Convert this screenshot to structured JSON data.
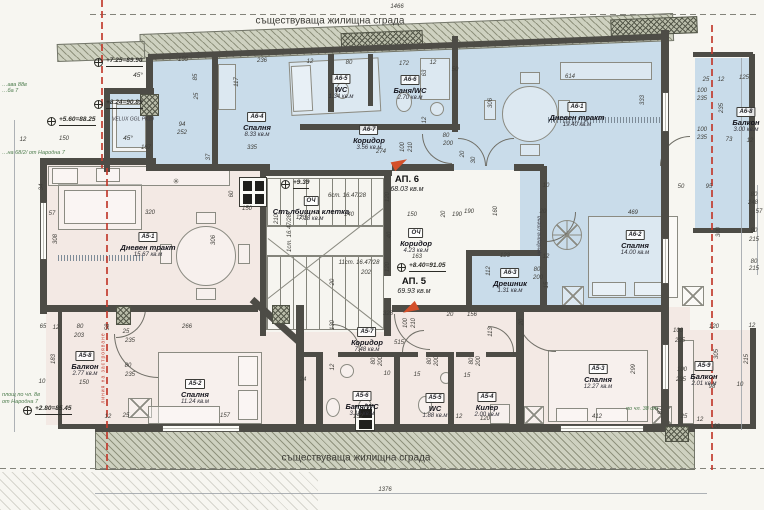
{
  "titles": {
    "top": "съществуваща жилищна сграда",
    "bottom": "съществуваща жилищна сграда"
  },
  "apartments": [
    {
      "id": "АП. 6",
      "area": "68.03 кв.м",
      "x": 407,
      "y": 175
    },
    {
      "id": "АП. 5",
      "area": "69.93 кв.м",
      "x": 414,
      "y": 277
    }
  ],
  "rooms": [
    {
      "code": "А6-1",
      "name": "Дневен тракт",
      "area": "19.40 кв.м",
      "x": 577,
      "y": 96
    },
    {
      "code": "А6-2",
      "name": "Спалня",
      "area": "14.00 кв.м",
      "x": 635,
      "y": 224
    },
    {
      "code": "А6-3",
      "name": "Дрешник",
      "area": "1.31 кв.м",
      "x": 510,
      "y": 262
    },
    {
      "code": "А6-4",
      "name": "Спалня",
      "area": "8.33 кв.м",
      "x": 257,
      "y": 106
    },
    {
      "code": "А6-5",
      "name": "WC",
      "area": "1.34 кв.м",
      "x": 341,
      "y": 68
    },
    {
      "code": "А6-6",
      "name": "Баня/WC",
      "area": "2.70 кв.м",
      "x": 410,
      "y": 69
    },
    {
      "code": "А6-7",
      "name": "Коридор",
      "area": "3.56 кв.м",
      "x": 369,
      "y": 119
    },
    {
      "code": "А6-8",
      "name": "Балкон",
      "area": "3.00 кв.м",
      "x": 746,
      "y": 101
    },
    {
      "code": "ОЧ",
      "name": "Стълбищна клетка",
      "area": "7.18 кв.м",
      "x": 311,
      "y": 190
    },
    {
      "code": "ОЧ",
      "name": "Коридор",
      "area": "4.23 кв.м",
      "x": 416,
      "y": 222
    },
    {
      "code": "А5-1",
      "name": "Дневен тракт",
      "area": "15.67 кв.м",
      "x": 148,
      "y": 226
    },
    {
      "code": "А5-2",
      "name": "Спалня",
      "area": "11.24 кв.м",
      "x": 195,
      "y": 373
    },
    {
      "code": "А5-3",
      "name": "Спалня",
      "area": "12.27 кв.м",
      "x": 598,
      "y": 358
    },
    {
      "code": "А5-4",
      "name": "Килер",
      "area": "2.00 кв.м",
      "x": 487,
      "y": 386
    },
    {
      "code": "А5-5",
      "name": "WC",
      "area": "1.88 кв.м",
      "x": 435,
      "y": 387
    },
    {
      "code": "А5-6",
      "name": "Баня/WC",
      "area": "3.10 кв.м",
      "x": 362,
      "y": 385
    },
    {
      "code": "А5-7",
      "name": "Коридор",
      "area": "7.48 кв.м",
      "x": 367,
      "y": 321
    },
    {
      "code": "А5-8",
      "name": "Балкон",
      "area": "2.77 кв.м",
      "x": 85,
      "y": 345
    },
    {
      "code": "А5-9",
      "name": "Балкон",
      "area": "2.01 кв.м",
      "x": 704,
      "y": 355
    }
  ],
  "stair_runs": [
    [
      "6ст. 16.47/28",
      347,
      196,
      0
    ],
    [
      "1ст. 16.47/28",
      290,
      233,
      1
    ],
    [
      "11ст. 16.47/28",
      359,
      263,
      0
    ]
  ],
  "levels": [
    {
      "t": "+7.25=89.90",
      "x": 106,
      "y": 62
    },
    {
      "t": "+8.24=90.89",
      "x": 106,
      "y": 104
    },
    {
      "t": "+5.60=88.25",
      "x": 59,
      "y": 121
    },
    {
      "t": "+2.80=85.45",
      "x": 35,
      "y": 410
    },
    {
      "t": "+9.39",
      "x": 293,
      "y": 184
    },
    {
      "t": "+8.40=91.05",
      "x": 409,
      "y": 267
    }
  ],
  "notes": [
    [
      "VELUX GGL PK19",
      133,
      120,
      0,
      "tiny"
    ],
    [
      "45°",
      138,
      76,
      0,
      "deg"
    ],
    [
      "45°",
      128,
      139,
      0,
      "deg"
    ],
    [
      "✳",
      176,
      182,
      0,
      "star"
    ],
    [
      "щендерна стена",
      540,
      236,
      1,
      "tiny"
    ],
    [
      "линия на застрояване",
      104,
      368,
      1,
      "redtxt"
    ],
    [
      "…ава 88в",
      2,
      83,
      0,
      "green"
    ],
    [
      "…ба 7",
      2,
      89,
      0,
      "green"
    ],
    [
      "…на 68/2/ от Народна 7",
      2,
      151,
      0,
      "green"
    ],
    [
      "площ по чл. 8в",
      2,
      393,
      0,
      "green"
    ],
    [
      "от Народна 7",
      2,
      400,
      0,
      "green"
    ],
    [
      "по чл. 38 от",
      626,
      407,
      0,
      "green"
    ]
  ],
  "dims": [
    [
      "1466",
      397,
      7,
      0
    ],
    [
      "155",
      183,
      60,
      0
    ],
    [
      "236",
      262,
      61,
      0
    ],
    [
      "12",
      310,
      62,
      0
    ],
    [
      "80",
      349,
      63,
      0
    ],
    [
      "172",
      404,
      64,
      0
    ],
    [
      "12",
      433,
      63,
      0
    ],
    [
      "50",
      455,
      70,
      0
    ],
    [
      "63",
      425,
      73,
      1
    ],
    [
      "614",
      570,
      77,
      0
    ],
    [
      "25",
      706,
      80,
      0
    ],
    [
      "12",
      721,
      80,
      0
    ],
    [
      "125",
      744,
      78,
      0
    ],
    [
      "117",
      237,
      82,
      1
    ],
    [
      "85",
      196,
      77,
      1
    ],
    [
      "25",
      197,
      96,
      1
    ],
    [
      "94",
      182,
      125,
      0
    ],
    [
      "252",
      182,
      133,
      0
    ],
    [
      "167",
      146,
      148,
      0
    ],
    [
      "335",
      252,
      148,
      0
    ],
    [
      "37",
      209,
      157,
      1
    ],
    [
      "12",
      23,
      140,
      0
    ],
    [
      "150",
      64,
      139,
      0
    ],
    [
      "100",
      702,
      91,
      0
    ],
    [
      "235",
      702,
      99,
      0
    ],
    [
      "235",
      722,
      108,
      1
    ],
    [
      "333",
      643,
      100,
      1
    ],
    [
      "306",
      491,
      103,
      1
    ],
    [
      "100",
      702,
      130,
      0
    ],
    [
      "235",
      702,
      138,
      0
    ],
    [
      "73",
      729,
      140,
      0
    ],
    [
      "12",
      750,
      141,
      0
    ],
    [
      "80",
      446,
      136,
      0
    ],
    [
      "200",
      448,
      144,
      0
    ],
    [
      "20",
      463,
      154,
      1
    ],
    [
      "30",
      474,
      160,
      1
    ],
    [
      "274",
      381,
      152,
      0
    ],
    [
      "100",
      403,
      147,
      1
    ],
    [
      "210",
      411,
      147,
      1
    ],
    [
      "12",
      425,
      120,
      1
    ],
    [
      "306",
      214,
      240,
      1
    ],
    [
      "308",
      56,
      239,
      1
    ],
    [
      "57",
      52,
      214,
      0
    ],
    [
      "34",
      42,
      187,
      1
    ],
    [
      "320",
      150,
      213,
      0
    ],
    [
      "60",
      232,
      194,
      1
    ],
    [
      "150",
      247,
      209,
      0
    ],
    [
      "120",
      388,
      197,
      1
    ],
    [
      "140",
      349,
      215,
      0
    ],
    [
      "150",
      412,
      215,
      0
    ],
    [
      "20",
      444,
      214,
      1
    ],
    [
      "190",
      457,
      215,
      0
    ],
    [
      "40",
      390,
      235,
      1
    ],
    [
      "163",
      417,
      257,
      0
    ],
    [
      "120",
      388,
      267,
      1
    ],
    [
      "202",
      366,
      273,
      0
    ],
    [
      "20",
      333,
      282,
      1
    ],
    [
      "210",
      277,
      219,
      1
    ],
    [
      "120",
      301,
      218,
      0
    ],
    [
      "10",
      546,
      186,
      0
    ],
    [
      "50",
      681,
      187,
      0
    ],
    [
      "95",
      709,
      187,
      0
    ],
    [
      "80",
      754,
      195,
      0
    ],
    [
      "248",
      753,
      203,
      0
    ],
    [
      "57",
      759,
      212,
      0
    ],
    [
      "20",
      543,
      212,
      0
    ],
    [
      "469",
      633,
      213,
      0
    ],
    [
      "300",
      719,
      232,
      1
    ],
    [
      "80",
      754,
      231,
      0
    ],
    [
      "215",
      754,
      240,
      0
    ],
    [
      "80",
      754,
      262,
      0
    ],
    [
      "215",
      754,
      269,
      0
    ],
    [
      "123",
      505,
      256,
      0
    ],
    [
      "12",
      546,
      257,
      0
    ],
    [
      "80",
      537,
      270,
      0
    ],
    [
      "200",
      538,
      278,
      0
    ],
    [
      "15",
      547,
      285,
      1
    ],
    [
      "112",
      489,
      271,
      1
    ],
    [
      "190",
      469,
      212,
      0
    ],
    [
      "160",
      496,
      211,
      1
    ],
    [
      "65",
      43,
      327,
      0
    ],
    [
      "12",
      56,
      328,
      0
    ],
    [
      "80",
      80,
      327,
      0
    ],
    [
      "203",
      79,
      336,
      0
    ],
    [
      "58",
      108,
      327,
      1
    ],
    [
      "25",
      126,
      332,
      0
    ],
    [
      "235",
      130,
      341,
      0
    ],
    [
      "266",
      187,
      327,
      0
    ],
    [
      "80",
      128,
      366,
      0
    ],
    [
      "235",
      130,
      375,
      0
    ],
    [
      "10",
      42,
      382,
      0
    ],
    [
      "150",
      84,
      383,
      0
    ],
    [
      "183",
      54,
      359,
      1
    ],
    [
      "12",
      108,
      417,
      0
    ],
    [
      "25",
      126,
      416,
      0
    ],
    [
      "157",
      225,
      416,
      0
    ],
    [
      "328",
      388,
      314,
      0
    ],
    [
      "20",
      450,
      315,
      0
    ],
    [
      "156",
      472,
      315,
      0
    ],
    [
      "130",
      333,
      325,
      1
    ],
    [
      "100",
      406,
      323,
      1
    ],
    [
      "210",
      414,
      323,
      1
    ],
    [
      "515",
      399,
      343,
      0
    ],
    [
      "113",
      491,
      332,
      1
    ],
    [
      "80",
      374,
      361,
      1
    ],
    [
      "200",
      381,
      361,
      1
    ],
    [
      "80",
      430,
      361,
      1
    ],
    [
      "200",
      437,
      361,
      1
    ],
    [
      "80",
      472,
      361,
      1
    ],
    [
      "200",
      479,
      361,
      1
    ],
    [
      "10",
      387,
      374,
      0
    ],
    [
      "15",
      417,
      375,
      0
    ],
    [
      "15",
      467,
      376,
      0
    ],
    [
      "24",
      303,
      380,
      0
    ],
    [
      "12",
      333,
      367,
      1
    ],
    [
      "152",
      358,
      417,
      0
    ],
    [
      "12",
      459,
      417,
      0
    ],
    [
      "120",
      485,
      419,
      0
    ],
    [
      "20",
      522,
      322,
      1
    ],
    [
      "100",
      678,
      331,
      0
    ],
    [
      "235",
      680,
      341,
      0
    ],
    [
      "120",
      714,
      327,
      0
    ],
    [
      "12",
      752,
      326,
      0
    ],
    [
      "305",
      717,
      354,
      1
    ],
    [
      "215",
      747,
      359,
      1
    ],
    [
      "100",
      682,
      370,
      0
    ],
    [
      "235",
      681,
      380,
      0
    ],
    [
      "299",
      634,
      369,
      1
    ],
    [
      "98",
      712,
      387,
      0
    ],
    [
      "10",
      740,
      385,
      0
    ],
    [
      "412",
      597,
      417,
      0
    ],
    [
      "87",
      661,
      411,
      1
    ],
    [
      "25",
      684,
      417,
      0
    ],
    [
      "12",
      700,
      420,
      0
    ],
    [
      "108",
      715,
      427,
      0
    ],
    [
      "1376",
      385,
      490,
      0
    ]
  ],
  "colors": {
    "apartment6_zone": "#c9dcea",
    "apartment5_zone": "#f3e9e4",
    "wall": "#4d4c46",
    "existing_hatch": "#ced1c0",
    "regulation_line_red": "#c23b2e",
    "note_green": "#4e7d4e",
    "arrow_orange": "#d4502a"
  }
}
